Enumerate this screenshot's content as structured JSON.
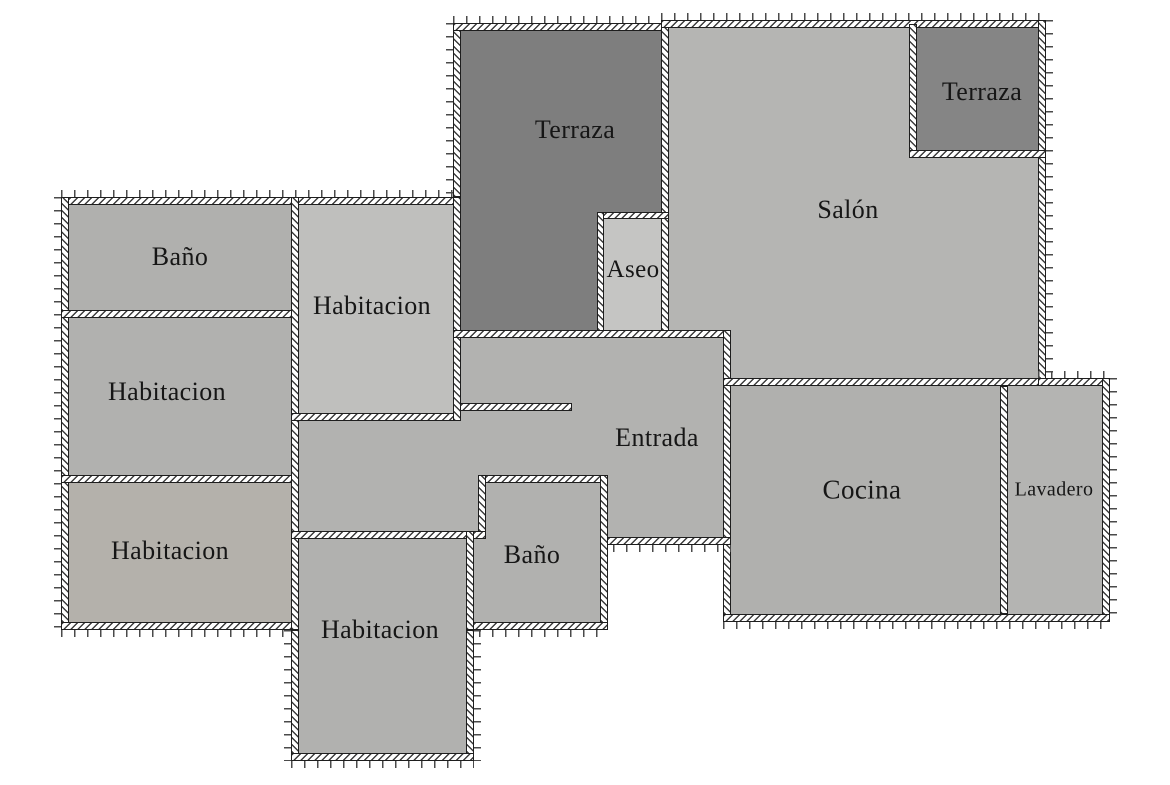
{
  "canvas": {
    "width": 1170,
    "height": 785,
    "background": "#ffffff"
  },
  "styles": {
    "wall_fill": "#ffffff",
    "hatch_color": "#3d3d3d",
    "wall_outline": "#1e1e1e",
    "tick_color": "#4a4a4a",
    "label_color": "#161616",
    "terrace_dark": "#7e7e7e",
    "room_gray": "#b1b1af"
  },
  "rooms": [
    {
      "id": "terraza-main",
      "label": "Terraza",
      "color": "#7e7e7e",
      "label_x": 575,
      "label_y": 130,
      "label_size": 26,
      "rects": [
        {
          "x": 461,
          "y": 31,
          "w": 200,
          "h": 299
        }
      ]
    },
    {
      "id": "salon",
      "label": "Salón",
      "color": "#b5b5b3",
      "label_x": 848,
      "label_y": 210,
      "label_size": 26,
      "rects": [
        {
          "x": 669,
          "y": 28,
          "w": 369,
          "h": 302
        },
        {
          "x": 731,
          "y": 330,
          "w": 307,
          "h": 48
        }
      ]
    },
    {
      "id": "terraza-tr",
      "label": "Terraza",
      "color": "#858585",
      "label_x": 982,
      "label_y": 92,
      "label_size": 26,
      "rects": [
        {
          "x": 917,
          "y": 28,
          "w": 121,
          "h": 122
        }
      ]
    },
    {
      "id": "aseo",
      "label": "Aseo",
      "color": "#c5c5c3",
      "label_x": 633,
      "label_y": 270,
      "label_size": 25,
      "rects": [
        {
          "x": 604,
          "y": 219,
          "w": 57,
          "h": 111
        }
      ]
    },
    {
      "id": "entrada",
      "label": "Entrada",
      "color": "#b2b2b0",
      "label_x": 657,
      "label_y": 438,
      "label_size": 26,
      "rects": [
        {
          "x": 461,
          "y": 338,
          "w": 262,
          "h": 199
        },
        {
          "x": 299,
          "y": 421,
          "w": 175,
          "h": 110
        }
      ]
    },
    {
      "id": "bano-centro",
      "label": "Baño",
      "color": "#b1b1af",
      "label_x": 532,
      "label_y": 555,
      "label_size": 26,
      "rects": [
        {
          "x": 486,
          "y": 483,
          "w": 114,
          "h": 48
        },
        {
          "x": 474,
          "y": 531,
          "w": 126,
          "h": 91
        }
      ]
    },
    {
      "id": "bano-tl",
      "label": "Baño",
      "color": "#b0b0ae",
      "label_x": 180,
      "label_y": 257,
      "label_size": 26,
      "rects": [
        {
          "x": 69,
          "y": 205,
          "w": 222,
          "h": 105
        }
      ]
    },
    {
      "id": "habitacion-izq-media",
      "label": "Habitacion",
      "color": "#b1b1af",
      "label_x": 167,
      "label_y": 392,
      "label_size": 26,
      "rects": [
        {
          "x": 69,
          "y": 318,
          "w": 222,
          "h": 157
        }
      ]
    },
    {
      "id": "habitacion-izq-baja",
      "label": "Habitacion",
      "color": "#b4b1ab",
      "label_x": 170,
      "label_y": 551,
      "label_size": 26,
      "rects": [
        {
          "x": 69,
          "y": 483,
          "w": 222,
          "h": 139
        }
      ]
    },
    {
      "id": "habitacion-central",
      "label": "Habitacion",
      "color": "#bfbfbd",
      "label_x": 372,
      "label_y": 306,
      "label_size": 26,
      "rects": [
        {
          "x": 299,
          "y": 205,
          "w": 154,
          "h": 208
        }
      ]
    },
    {
      "id": "habitacion-inferior",
      "label": "Habitacion",
      "color": "#b1b1af",
      "label_x": 380,
      "label_y": 630,
      "label_size": 26,
      "rects": [
        {
          "x": 299,
          "y": 539,
          "w": 167,
          "h": 214
        }
      ]
    },
    {
      "id": "cocina",
      "label": "Cocina",
      "color": "#b0b0ae",
      "label_x": 862,
      "label_y": 490,
      "label_size": 27,
      "rects": [
        {
          "x": 731,
          "y": 386,
          "w": 269,
          "h": 228
        }
      ]
    },
    {
      "id": "lavadero",
      "label": "Lavadero",
      "color": "#b4b4b2",
      "label_x": 1054,
      "label_y": 490,
      "label_size": 20,
      "rects": [
        {
          "x": 1008,
          "y": 386,
          "w": 94,
          "h": 228
        }
      ]
    }
  ],
  "walls": [
    {
      "x": 61,
      "y": 197,
      "w": 400,
      "h": 8,
      "dir": "h",
      "ticks": [
        "t"
      ]
    },
    {
      "x": 61,
      "y": 197,
      "w": 8,
      "h": 433,
      "dir": "v",
      "ticks": [
        "l"
      ]
    },
    {
      "x": 61,
      "y": 622,
      "w": 238,
      "h": 8,
      "dir": "h",
      "ticks": [
        "b"
      ]
    },
    {
      "x": 61,
      "y": 310,
      "w": 238,
      "h": 8,
      "dir": "h"
    },
    {
      "x": 61,
      "y": 475,
      "w": 238,
      "h": 8,
      "dir": "h"
    },
    {
      "x": 291,
      "y": 197,
      "w": 8,
      "h": 433,
      "dir": "v"
    },
    {
      "x": 291,
      "y": 630,
      "w": 8,
      "h": 131,
      "dir": "v",
      "ticks": [
        "l"
      ]
    },
    {
      "x": 291,
      "y": 413,
      "w": 170,
      "h": 8,
      "dir": "h"
    },
    {
      "x": 453,
      "y": 403,
      "w": 119,
      "h": 8,
      "dir": "h"
    },
    {
      "x": 453,
      "y": 23,
      "w": 8,
      "h": 174,
      "dir": "v",
      "ticks": [
        "l"
      ]
    },
    {
      "x": 453,
      "y": 197,
      "w": 8,
      "h": 224,
      "dir": "v"
    },
    {
      "x": 453,
      "y": 23,
      "w": 216,
      "h": 8,
      "dir": "h",
      "ticks": [
        "t"
      ]
    },
    {
      "x": 661,
      "y": 23,
      "w": 8,
      "h": 315,
      "dir": "v"
    },
    {
      "x": 597,
      "y": 212,
      "w": 72,
      "h": 7,
      "dir": "h"
    },
    {
      "x": 597,
      "y": 212,
      "w": 7,
      "h": 126,
      "dir": "v"
    },
    {
      "x": 453,
      "y": 330,
      "w": 278,
      "h": 8,
      "dir": "h"
    },
    {
      "x": 661,
      "y": 20,
      "w": 385,
      "h": 8,
      "dir": "h",
      "ticks": [
        "t"
      ]
    },
    {
      "x": 1038,
      "y": 20,
      "w": 8,
      "h": 366,
      "dir": "v",
      "ticks": [
        "r"
      ]
    },
    {
      "x": 909,
      "y": 24,
      "w": 8,
      "h": 133,
      "dir": "v"
    },
    {
      "x": 909,
      "y": 150,
      "w": 137,
      "h": 8,
      "dir": "h"
    },
    {
      "x": 723,
      "y": 330,
      "w": 8,
      "h": 292,
      "dir": "v"
    },
    {
      "x": 723,
      "y": 378,
      "w": 323,
      "h": 8,
      "dir": "h"
    },
    {
      "x": 1038,
      "y": 378,
      "w": 72,
      "h": 8,
      "dir": "h",
      "ticks": [
        "t"
      ]
    },
    {
      "x": 1102,
      "y": 378,
      "w": 8,
      "h": 244,
      "dir": "v",
      "ticks": [
        "r"
      ]
    },
    {
      "x": 723,
      "y": 614,
      "w": 387,
      "h": 8,
      "dir": "h",
      "ticks": [
        "b"
      ]
    },
    {
      "x": 1000,
      "y": 386,
      "w": 8,
      "h": 228,
      "dir": "v"
    },
    {
      "x": 600,
      "y": 537,
      "w": 131,
      "h": 8,
      "dir": "h",
      "ticks": [
        "b"
      ]
    },
    {
      "x": 478,
      "y": 475,
      "w": 130,
      "h": 8,
      "dir": "h"
    },
    {
      "x": 478,
      "y": 475,
      "w": 8,
      "h": 64,
      "dir": "v"
    },
    {
      "x": 466,
      "y": 531,
      "w": 20,
      "h": 8,
      "dir": "h"
    },
    {
      "x": 600,
      "y": 475,
      "w": 8,
      "h": 155,
      "dir": "v"
    },
    {
      "x": 466,
      "y": 622,
      "w": 142,
      "h": 8,
      "dir": "h",
      "ticks": [
        "b"
      ]
    },
    {
      "x": 291,
      "y": 531,
      "w": 183,
      "h": 8,
      "dir": "h"
    },
    {
      "x": 466,
      "y": 531,
      "w": 8,
      "h": 99,
      "dir": "v"
    },
    {
      "x": 466,
      "y": 630,
      "w": 8,
      "h": 131,
      "dir": "v",
      "ticks": [
        "r"
      ]
    },
    {
      "x": 291,
      "y": 753,
      "w": 183,
      "h": 8,
      "dir": "h",
      "ticks": [
        "b"
      ]
    }
  ]
}
